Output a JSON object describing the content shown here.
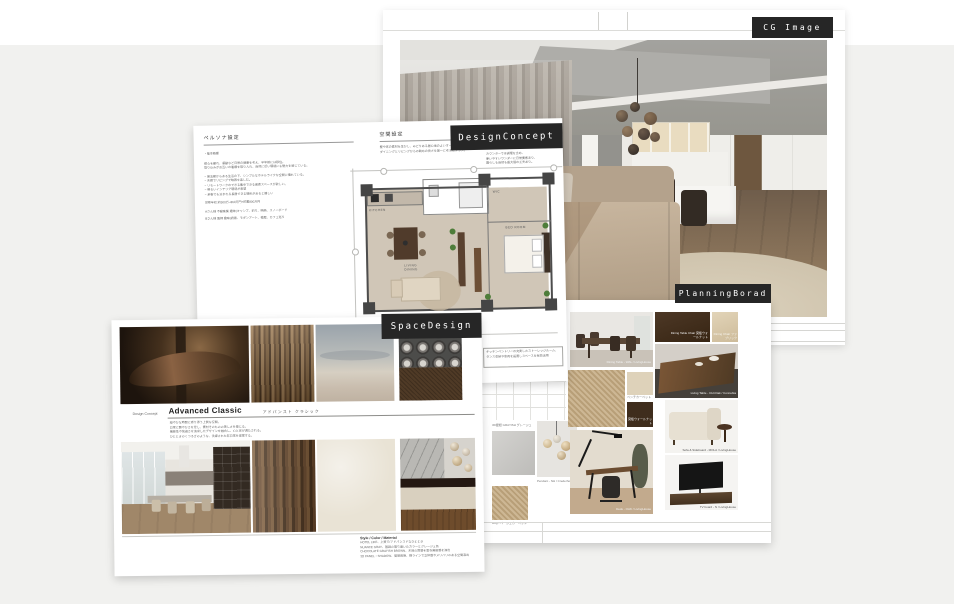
{
  "page": {
    "bg_gray": "#f1f1ef",
    "top_strip": "#ffffff"
  },
  "tags": {
    "cg_image": "CG Image",
    "design_concept": "DesignConcept",
    "planning_board": "PlanningBorad",
    "space_design": "SpaceDesign",
    "tag_bg": "#262626",
    "tag_color": "#ffffff"
  },
  "design_concept_sheet": {
    "left_header": "ペルソナ設定",
    "right_header": "空間設定",
    "left_lines": [
      "・基本概要",
      "都心を離れ、運動など日常の健康を考え、半年前には移住。",
      "取り込みがお互いの看護を取り入れ、自然に近い環境にも魅力を感じている。",
      "− 第五期からある生活の下、シンプルなホテルライクな空間に憧れている。",
      "− 夫婦でリビングで映画を楽しむ。",
      "− リモートワークのできる集中できる書斎スペースが欲しい。",
      "− 明るいインテリア環境が希望",
      "− 来客でも泊まれる長居できる場所があると嬉しい",
      "世帯年収:約500万−860万円+貯蓄800万円",
      "Aさん様 不動産業 趣味(キャンプ、釣り、映画、スノーボード",
      "Bさん様 医師 趣味(読書、モダンアート、植栽、カフェ巡り"
    ],
    "right_lines": [
      "壁や床の素材を生かし、みどりある居心地のよいオープンキッチン、",
      "ダイニングとリビングからの眺めの良さを第一に考えたプラン。"
    ],
    "side_note_lines": [
      "カウンターでは調理を含め、",
      "使いやすいワンダーに日常要素あり、",
      "暮らしも自然も最大限の工夫あり。"
    ],
    "annotation_lines": [
      "キッチンペントリーの充実したストーレッジルーム、",
      "タンス収納や家具を設置しスペースを有効活用"
    ],
    "plan": {
      "kitchen": "KITCHEN",
      "living": "LIVING DINING",
      "bedroom": "BED ROOM",
      "wic": "WIC"
    }
  },
  "space_design_sheet": {
    "concept_label": "Design Concept",
    "title": "Advanced Classic",
    "title_kana": "アドバンスト クラシック",
    "description_lines": [
      "穏やかな時間に寄り添う上質な空間。",
      "日常に艶やかさを足し、素材そのものの美しさを感じる。",
      "機能性や快適さを追求したデザインを融合し、心と体が満たされる。",
      "ひとときのくつろぎのような、洗練された非日常を提案する。"
    ],
    "style_header": "Style / Color / Material",
    "style_lines": [
      "HOTEL LIKE、上質で/アドバンスドなひととき",
      "NUANCE GRAY、基調の落ち着いたカラーとグレージュ色",
      "CHOCOLATE GRAYISH BROWN、木目の質感を重ね高級感を演出",
      "3D PANEL・SHADOW、間接照明、横ラインで立体感やメリハリのある空間演出"
    ]
  },
  "planning_board_sheet": {
    "captions": {
      "dining_table": "Dining Table - WAL / LivingHouse",
      "dining_chair": "Dining Table Chair 突板ウォールナット",
      "dining_fabric": "Dining Chair ファブリック",
      "living_table": "Living Table - CH×Oak / Connubia",
      "carpet_small": "ベンチカーペット",
      "walnut_swatch": "突板ウォールナット",
      "gray_swatch": "3D壁紙 GRAYISH グレージュ",
      "pendant": "Pendant - NH / Crederhous",
      "rug": "Rug - ベージュカーペット",
      "desk": "Desk - OAK / LivingHouse",
      "sofa": "Sofa & Sideboard - MOLA / LivingHouse",
      "tv_board": "TV board - N / LivingHouse"
    }
  }
}
